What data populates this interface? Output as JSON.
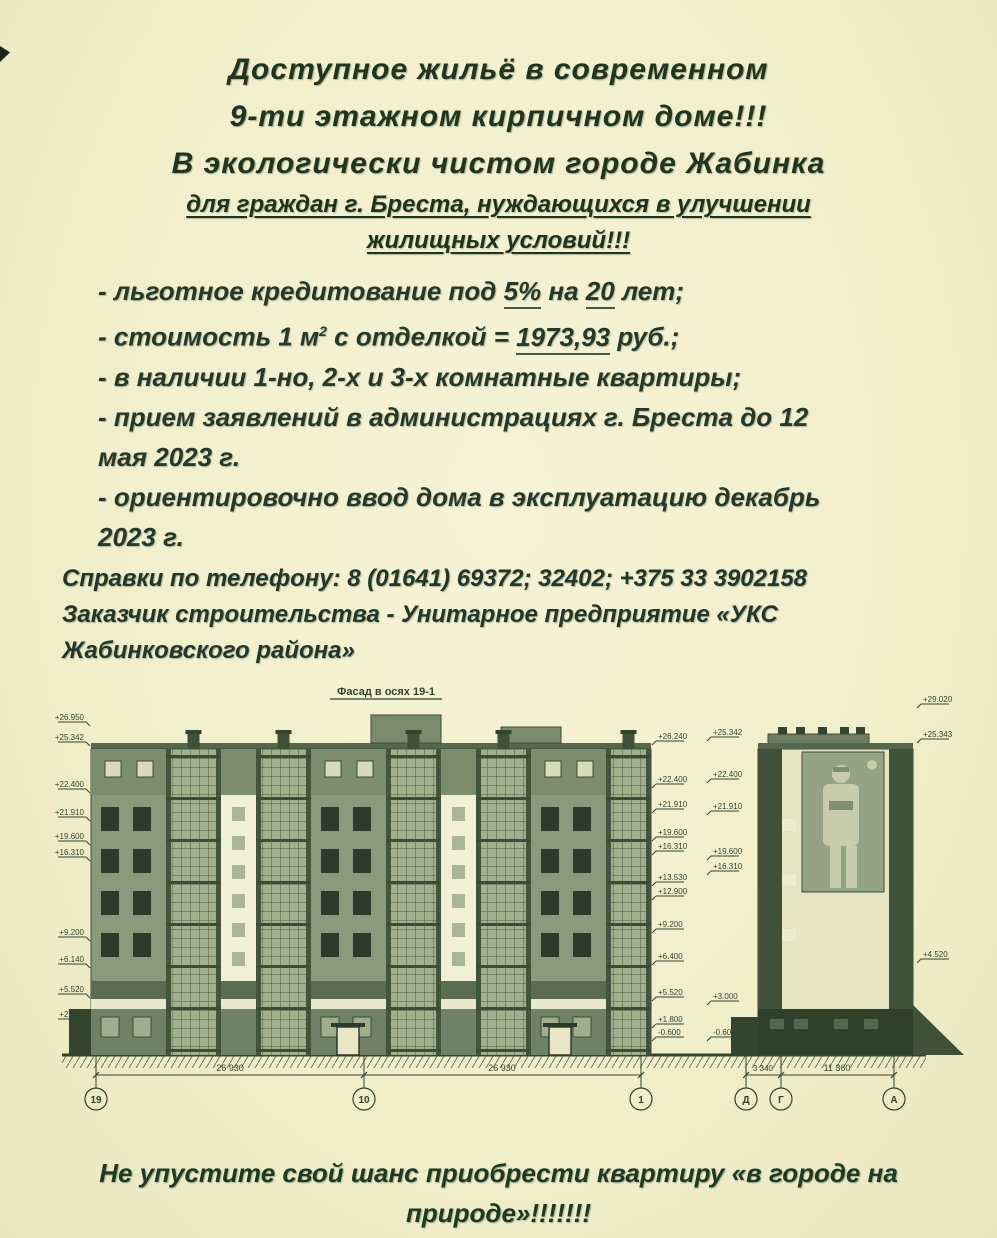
{
  "palette": {
    "paper": "#f2efcd",
    "ink": "#20351f",
    "drawing_ink": "#2e4431",
    "facade_wall": "#8a9a7c",
    "facade_glazing": "#a2b08e",
    "facade_dark": "#3f5239",
    "facade_white": "#f1efd5",
    "window_dark": "#2c3b2c"
  },
  "title": {
    "line1": "Доступное жильё в современном",
    "line2": "9-ти этажном кирпичном доме!!!",
    "line3": "В экологически чистом городе Жабинка",
    "line4": "для граждан г. Бреста, нуждающихся в улучшении",
    "line5": "жилищных условий!!!"
  },
  "bullets": {
    "b1": {
      "t1": "- льготное кредитование  под ",
      "u1": "5%",
      "t2": " на ",
      "u2": "20",
      "t3": " лет;"
    },
    "b2": {
      "t1": "- стоимость 1 м",
      "sup": "2",
      "t2": " с отделкой = ",
      "u1": "1973,93",
      "t3": " руб.;"
    },
    "b3": {
      "t1": "- в наличии 1-но, 2-х и 3-х комнатные квартиры;"
    },
    "b4": {
      "t1": "- прием заявлений в администрациях г. Бреста до 12",
      "t2": "мая 2023 г."
    },
    "b5": {
      "t1": "- ориентировочно ввод дома в эксплуатацию декабрь",
      "t2": "2023 г."
    }
  },
  "contact": {
    "line1": "Справки по телефону: 8 (01641) 69372; 32402; +375 33 3902158",
    "line2": "Заказчик строительства - Унитарное предприятие «УКС",
    "line3": "Жабинковского района»"
  },
  "drawing": {
    "title": "Фасад в осях 19-1",
    "elevation_marks_left": [
      "+26.950",
      "+25.342",
      "+22.400",
      "+21.910",
      "+19.600",
      "+16.310",
      "+9.200",
      "+6.140",
      "+5.520",
      "+2.760"
    ],
    "elevation_marks_mid": [
      "+26.240",
      "+22.400",
      "+21.910",
      "+19.600",
      "+16.310",
      "+13.530",
      "+12.900",
      "+9.200",
      "+6.400",
      "+5.520",
      "+1.800",
      "-0.600"
    ],
    "end_facade_marks_left": [
      "+25.342",
      "+22.400",
      "+21.910",
      "+19.600",
      "+16.310",
      "+3.000",
      "-0.600"
    ],
    "end_facade_marks_right": [
      "+29.020",
      "+25.343",
      "+4.520"
    ],
    "main_dims": [
      "26 930",
      "26 930"
    ],
    "end_dims": [
      "3 340",
      "11 360"
    ],
    "main_axes": [
      "19",
      "10",
      "1"
    ],
    "end_axes": [
      "Д",
      "Г",
      "А"
    ]
  },
  "footer": {
    "line1": "Не упустите свой шанс приобрести квартиру «в городе на",
    "line2": "природе»!!!!!!!"
  }
}
